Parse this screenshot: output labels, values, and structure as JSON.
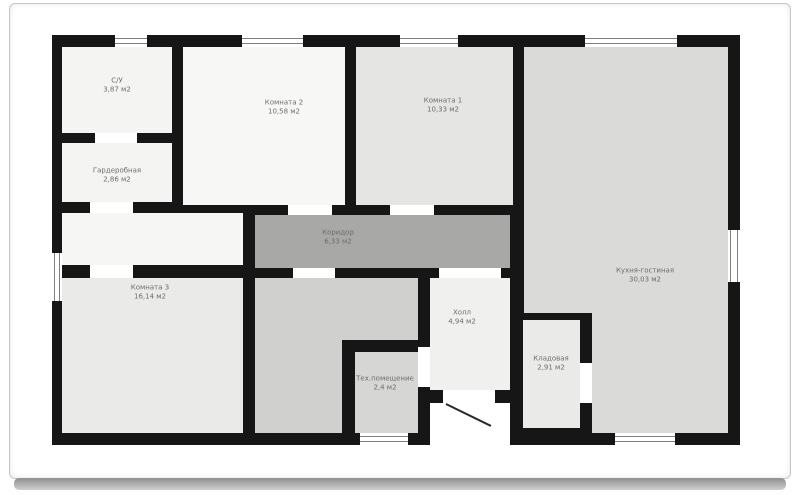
{
  "document": {
    "type": "floor-plan",
    "language": "ru",
    "units_label": "м2"
  },
  "colors": {
    "wall": "#161616",
    "page": "#ffffff",
    "frame_border": "#c6c6c6",
    "label_text": "#6d6d6d",
    "corridor_floor": "#a8a8a6",
    "kitchen_floor": "#dadad8"
  },
  "rooms": [
    {
      "id": "su",
      "label": "С/У",
      "area": "3,87 м2",
      "cx": 117,
      "cy": 86
    },
    {
      "id": "wardrobe",
      "label": "Гардеробная",
      "area": "2,86 м2",
      "cx": 117,
      "cy": 176
    },
    {
      "id": "room2",
      "label": "Комната 2",
      "area": "10,58 м2",
      "cx": 284,
      "cy": 108
    },
    {
      "id": "room1",
      "label": "Комната 1",
      "area": "10,33 м2",
      "cx": 443,
      "cy": 106
    },
    {
      "id": "corridor",
      "label": "Коридор",
      "area": "6,33 м2",
      "cx": 338,
      "cy": 238
    },
    {
      "id": "room3",
      "label": "Комната 3",
      "area": "16,14 м2",
      "cx": 150,
      "cy": 293
    },
    {
      "id": "kitchen",
      "label": "Кухня-гостиная",
      "area": "30,03 м2",
      "cx": 645,
      "cy": 276
    },
    {
      "id": "hall",
      "label": "Холл",
      "area": "4,94 м2",
      "cx": 462,
      "cy": 318
    },
    {
      "id": "tech",
      "label": "Тех.помещение",
      "area": "2,4 м2",
      "cx": 385,
      "cy": 384
    },
    {
      "id": "pantry",
      "label": "Кладовая",
      "area": "2,91 м2",
      "cx": 551,
      "cy": 364
    }
  ],
  "plan": {
    "base": {
      "x": 52,
      "y": 35,
      "w": 688,
      "h": 410
    },
    "floors": [
      {
        "room": "su",
        "x": 62,
        "y": 47,
        "w": 110,
        "h": 86,
        "color": "#f4f4f2"
      },
      {
        "room": "wardrobe",
        "x": 62,
        "y": 143,
        "w": 110,
        "h": 59,
        "color": "#f4f4f2"
      },
      {
        "room": "nook",
        "x": 62,
        "y": 213,
        "w": 181,
        "h": 52,
        "color": "#f6f6f4"
      },
      {
        "room": "room2",
        "x": 183,
        "y": 47,
        "w": 162,
        "h": 158,
        "color": "#f7f7f5"
      },
      {
        "room": "room1",
        "x": 356,
        "y": 47,
        "w": 157,
        "h": 158,
        "color": "#e5e5e3"
      },
      {
        "room": "corridor",
        "x": 255,
        "y": 215,
        "w": 255,
        "h": 53,
        "color": "#a8a8a6"
      },
      {
        "room": "room3",
        "x": 62,
        "y": 278,
        "w": 181,
        "h": 155,
        "color": "#eaeae8"
      },
      {
        "room": "entry-main",
        "x": 255,
        "y": 278,
        "w": 87,
        "h": 155,
        "color": "#d0d0ce"
      },
      {
        "room": "entry-arm",
        "x": 342,
        "y": 278,
        "w": 76,
        "h": 62,
        "color": "#d0d0ce"
      },
      {
        "room": "tech",
        "x": 355,
        "y": 352,
        "w": 63,
        "h": 81,
        "color": "#d6d6d4"
      },
      {
        "room": "hall",
        "x": 430,
        "y": 278,
        "w": 80,
        "h": 112,
        "color": "#f0f0ee"
      },
      {
        "room": "pantry",
        "x": 523,
        "y": 320,
        "w": 57,
        "h": 108,
        "color": "#eaeae8"
      },
      {
        "room": "kitchen-main",
        "x": 524,
        "y": 47,
        "w": 204,
        "h": 266,
        "color": "#dadad8"
      },
      {
        "room": "kitchen-ext",
        "x": 592,
        "y": 313,
        "w": 136,
        "h": 120,
        "color": "#dadad8"
      },
      {
        "room": "porch",
        "x": 430,
        "y": 403,
        "w": 80,
        "h": 42,
        "color": "#ffffff"
      }
    ],
    "windows": [
      {
        "dir": "h",
        "x": 115,
        "y": 35,
        "w": 32,
        "h": 12
      },
      {
        "dir": "h",
        "x": 242,
        "y": 35,
        "w": 61,
        "h": 12
      },
      {
        "dir": "h",
        "x": 400,
        "y": 35,
        "w": 58,
        "h": 12
      },
      {
        "dir": "h",
        "x": 585,
        "y": 35,
        "w": 92,
        "h": 12
      },
      {
        "dir": "h",
        "x": 360,
        "y": 433,
        "w": 48,
        "h": 12
      },
      {
        "dir": "h",
        "x": 615,
        "y": 433,
        "w": 60,
        "h": 12
      },
      {
        "dir": "v",
        "x": 52,
        "y": 253,
        "w": 10,
        "h": 48
      },
      {
        "dir": "v",
        "x": 728,
        "y": 230,
        "w": 12,
        "h": 52
      }
    ],
    "doors": [
      {
        "name": "su-wardrobe",
        "x": 95,
        "y": 133,
        "w": 42,
        "h": 10
      },
      {
        "name": "wardrobe-nook",
        "x": 90,
        "y": 202,
        "w": 43,
        "h": 11
      },
      {
        "name": "nook-room3",
        "x": 90,
        "y": 265,
        "w": 43,
        "h": 13
      },
      {
        "name": "room2-corridor",
        "x": 288,
        "y": 205,
        "w": 44,
        "h": 10
      },
      {
        "name": "room1-corridor",
        "x": 390,
        "y": 205,
        "w": 44,
        "h": 10
      },
      {
        "name": "corridor-entry",
        "x": 293,
        "y": 268,
        "w": 42,
        "h": 10
      },
      {
        "name": "corridor-hall",
        "x": 439,
        "y": 268,
        "w": 62,
        "h": 10
      },
      {
        "name": "hall-tech",
        "x": 418,
        "y": 347,
        "w": 12,
        "h": 40
      },
      {
        "name": "pantry-kitchen",
        "x": 580,
        "y": 363,
        "w": 12,
        "h": 40
      },
      {
        "name": "entrance",
        "x": 443,
        "y": 390,
        "w": 52,
        "h": 13
      }
    ],
    "door_leaf": {
      "x": 446,
      "y": 403,
      "length": 50,
      "angle_deg": 26
    }
  }
}
